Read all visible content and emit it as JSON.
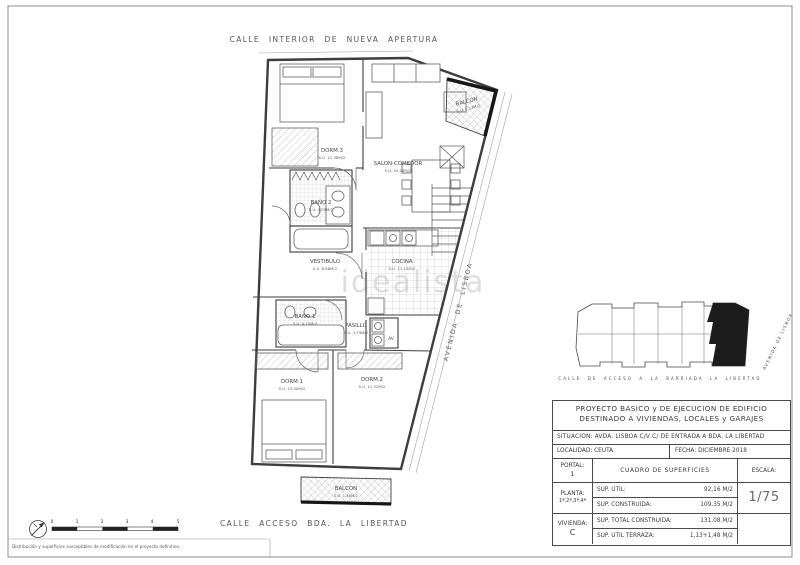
{
  "streets": {
    "top": "CALLE INTERIOR DE NUEVA APERTURA",
    "bottom": "CALLE ACCESO BDA. LA LIBERTAD",
    "right_diagonal": "AVENIDA DE LISBOA"
  },
  "watermark": "idealista",
  "rooms": {
    "dorm3": {
      "name": "DORM.3",
      "area": "S.U. 12,38M/2"
    },
    "salon": {
      "name": "SALON-COMEDOR",
      "area": "S.U. 20,16M/2"
    },
    "bano2": {
      "name": "BAÑO 2",
      "area": "S.U. 4,09M/2"
    },
    "vestibulo": {
      "name": "VESTIBULO",
      "area": "S.U. 6,68M/2"
    },
    "cocina": {
      "name": "COCINA",
      "area": "S.U. 11,15M/2"
    },
    "bano1": {
      "name": "BAÑO 1",
      "area": "S.U. 4,10M/2"
    },
    "pasillo": {
      "name": "PASILLO",
      "area": "S.U. 3,79M/2"
    },
    "dorm1": {
      "name": "DORM.1",
      "area": "S.U. 15,00M/2"
    },
    "dorm2": {
      "name": "DORM.2",
      "area": "S.U. 12,32M/2"
    },
    "balcon_top": {
      "name": "BALCON",
      "area": "S.U. 1,13M/2"
    },
    "balcon_bottom": {
      "name": "BALCON",
      "area": "S.U. 1,48M/2"
    },
    "av_closet": "AV"
  },
  "keyplan": {
    "street_bottom": "CALLE DE ACCESO A LA BARRIADA LA LIBERTAD",
    "street_right": "AVENIDA DE LISBOA"
  },
  "titleblock": {
    "title_line1": "PROYECTO BASICO y DE EJECUCION DE EDIFICIO",
    "title_line2": "DESTINADO A VIVIENDAS, LOCALES y GARAJES",
    "situacion": "SITUACION: AVDA. LISBOA C/V C/ DE ENTRADA A BDA. LA LIBERTAD",
    "localidad": "LOCALIDAD: CEUTA",
    "fecha": "FECHA: DICIEMBRE 2018",
    "portal_label": "PORTAL:",
    "portal_value": "1",
    "planta_label": "PLANTA:",
    "planta_value": "1ª,2ª,3ª,4ª",
    "vivienda_label": "VIVIENDA:",
    "vivienda_value": "C",
    "cuadro_header": "CUADRO DE SUPERFICIES",
    "rows": [
      {
        "label": "SUP. UTIL:",
        "value": "92,16 M/2"
      },
      {
        "label": "SUP. CONSTRUIDA:",
        "value": "109,35 M/2"
      },
      {
        "label": "SUP. TOTAL CONSTRUIDA:",
        "value": "131,08 M/2"
      },
      {
        "label": "SUP. UTIL TERRAZA:",
        "value": "1,13+1,48 M/2"
      }
    ],
    "escala_label": "ESCALA:",
    "escala_value": "1/75"
  },
  "scalebar": {
    "ticks": [
      "0",
      "1",
      "2",
      "3",
      "4",
      "5"
    ]
  },
  "footnote": "Distribución y superficies susceptibles de modificación en el proyecto definitivo.",
  "colors": {
    "line": "#3d3d3d",
    "poche": "#161616",
    "paper": "#ffffff"
  }
}
